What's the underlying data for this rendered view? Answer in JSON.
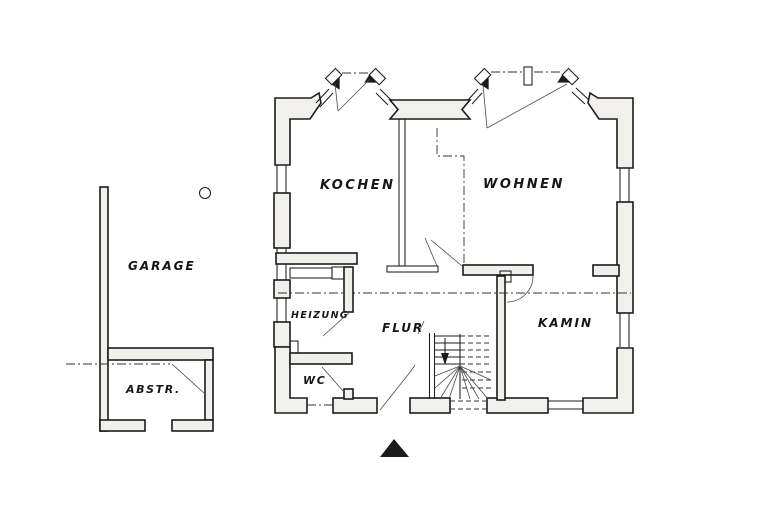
{
  "rooms": {
    "garage": "GARAGE",
    "abstellraum": "ABSTR.",
    "kochen": "KOCHEN",
    "wohnen": "WOHNEN",
    "heizung": "HEIZUNG",
    "flur": "FLUR",
    "wc": "WC",
    "kamin": "KAMIN"
  },
  "colors": {
    "ink": "#1c1c1c",
    "wall_fill": "#f1f0ec",
    "paper": "#ffffff"
  }
}
